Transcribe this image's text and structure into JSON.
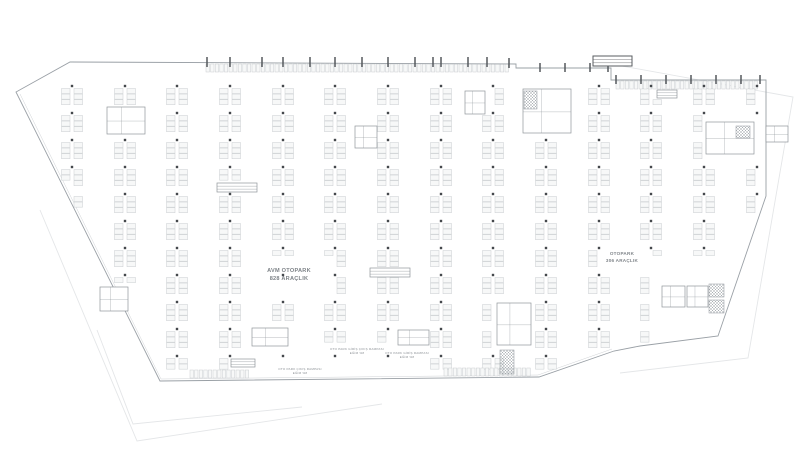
{
  "plan": {
    "labels": {
      "avm_line1": "AVM OTOPARK",
      "avm_line2": "828 ARAÇLIK",
      "right_line1": "OTOPARK",
      "right_line2": "306 ARAÇLIK",
      "ramp_a_line1": "OTO PARK GİRİŞ ÇIKIŞ RAMPASI",
      "ramp_a_line2": "EĞİM %8",
      "ramp_b_line1": "OTO PARK GİRİŞ RAMPASI",
      "ramp_b_line2": "EĞİM %8",
      "ramp_c_line1": "OTO PARK ÇIKIŞ RAMPASI",
      "ramp_c_line2": "EĞİM %8"
    },
    "colors": {
      "background": "#ffffff",
      "outline": "#9aa0a6",
      "faint": "#e4e6e8",
      "stall_stroke": "#c9cdd0",
      "stall_fill": "#f7f8f8",
      "column": "#44484c",
      "core_stroke": "#8f959a",
      "hatch": "#a8aeb2",
      "tick": "#55595d",
      "text": "#7d8287"
    },
    "geometry": {
      "outline_main": [
        [
          70,
          62
        ],
        [
          516,
          64
        ],
        [
          516,
          68
        ],
        [
          611,
          68
        ],
        [
          611,
          80
        ],
        [
          766,
          80
        ],
        [
          766,
          196
        ],
        [
          718,
          336
        ],
        [
          640,
          346
        ],
        [
          614,
          351
        ],
        [
          539,
          377
        ],
        [
          160,
          381
        ],
        [
          16,
          92
        ]
      ],
      "inner_wall": [
        [
          20,
          94
        ],
        [
          161,
          379
        ],
        [
          538,
          375
        ],
        [
          612,
          349
        ]
      ],
      "underlay": [
        [
          [
            40,
            210
          ],
          [
            137,
            441
          ],
          [
            382,
            404
          ]
        ],
        [
          [
            97,
            330
          ],
          [
            133,
            424
          ],
          [
            302,
            407
          ]
        ],
        [
          [
            611,
            64
          ],
          [
            793,
            97
          ],
          [
            748,
            358
          ],
          [
            620,
            373
          ]
        ]
      ],
      "cols": [
        72,
        125,
        177,
        230,
        283,
        335,
        388,
        441,
        493,
        546,
        599,
        651,
        704,
        757
      ],
      "rows": [
        86,
        113,
        140,
        167,
        194,
        221,
        248,
        275,
        302,
        329,
        356,
        376
      ],
      "stall": {
        "offsets": [
          -10.5,
          2
        ],
        "w": 8.5,
        "h": 5.1,
        "step": 5.55,
        "pad": 2.5
      },
      "no_stall": [
        [
          100,
          104,
          48,
          32
        ],
        [
          348,
          122,
          32,
          28
        ],
        [
          458,
          87,
          32,
          30
        ],
        [
          516,
          84,
          60,
          52
        ],
        [
          488,
          298,
          48,
          52
        ],
        [
          645,
          256,
          92,
          88
        ],
        [
          698,
          116,
          60,
          44
        ],
        [
          96,
          282,
          38,
          30
        ],
        [
          244,
          323,
          50,
          24
        ],
        [
          390,
          325,
          44,
          22
        ],
        [
          250,
          256,
          80,
          36
        ],
        [
          596,
          242,
          54,
          24
        ],
        [
          160,
          186,
          360,
          12
        ],
        [
          215,
          181,
          44,
          13
        ],
        [
          368,
          266,
          44,
          13
        ],
        [
          655,
          88,
          24,
          12
        ],
        [
          270,
          342,
          160,
          36
        ],
        [
          228,
          357,
          30,
          12
        ]
      ],
      "no_col": [
        [
          100,
          104,
          48,
          32
        ],
        [
          348,
          122,
          32,
          28
        ],
        [
          458,
          87,
          32,
          30
        ],
        [
          516,
          84,
          60,
          52
        ],
        [
          488,
          298,
          48,
          52
        ],
        [
          645,
          256,
          92,
          88
        ],
        [
          698,
          116,
          60,
          44
        ],
        [
          96,
          282,
          38,
          30
        ],
        [
          244,
          323,
          50,
          24
        ],
        [
          390,
          325,
          44,
          22
        ]
      ],
      "cores": [
        [
          107,
          107,
          38,
          27
        ],
        [
          355,
          126,
          22,
          22
        ],
        [
          465,
          91,
          20,
          23
        ],
        [
          523,
          89,
          48,
          44
        ],
        [
          497,
          303,
          34,
          42
        ],
        [
          662,
          286,
          23,
          21
        ],
        [
          687,
          286,
          21,
          21
        ],
        [
          706,
          122,
          48,
          32
        ],
        [
          100,
          287,
          28,
          24
        ],
        [
          252,
          328,
          36,
          18
        ],
        [
          398,
          330,
          31,
          15
        ],
        [
          766,
          126,
          22,
          16
        ]
      ],
      "hatches": [
        [
          524,
          91,
          13,
          18
        ],
        [
          500,
          350,
          14,
          24
        ],
        [
          709,
          284,
          15,
          13
        ],
        [
          709,
          300,
          15,
          13
        ],
        [
          736,
          126,
          14,
          12
        ]
      ],
      "ramps": [
        {
          "x": 217,
          "y": 183,
          "w": 40,
          "h": 9,
          "dark": false
        },
        {
          "x": 370,
          "y": 268,
          "w": 40,
          "h": 9,
          "dark": false
        },
        {
          "x": 593,
          "y": 56,
          "w": 39,
          "h": 10,
          "dark": true
        },
        {
          "x": 657,
          "y": 90,
          "w": 20,
          "h": 8,
          "dark": false
        },
        {
          "x": 231,
          "y": 359,
          "w": 24,
          "h": 8,
          "dark": false
        }
      ],
      "ticks": [
        {
          "x": 207,
          "y": 57,
          "h": 10
        },
        {
          "x": 230,
          "y": 57,
          "h": 10
        },
        {
          "x": 262,
          "y": 57,
          "h": 10
        },
        {
          "x": 283,
          "y": 57,
          "h": 10
        },
        {
          "x": 310,
          "y": 57,
          "h": 10
        },
        {
          "x": 335,
          "y": 57,
          "h": 10
        },
        {
          "x": 362,
          "y": 57,
          "h": 10
        },
        {
          "x": 388,
          "y": 57,
          "h": 10
        },
        {
          "x": 415,
          "y": 57,
          "h": 10
        },
        {
          "x": 433,
          "y": 57,
          "h": 10
        },
        {
          "x": 441,
          "y": 57,
          "h": 10
        },
        {
          "x": 468,
          "y": 57,
          "h": 10
        },
        {
          "x": 487,
          "y": 57,
          "h": 10
        },
        {
          "x": 509,
          "y": 58,
          "h": 10
        },
        {
          "x": 540,
          "y": 63,
          "h": 9
        },
        {
          "x": 565,
          "y": 63,
          "h": 9
        },
        {
          "x": 590,
          "y": 63,
          "h": 9
        },
        {
          "x": 608,
          "y": 63,
          "h": 9
        },
        {
          "x": 616,
          "y": 75,
          "h": 9
        },
        {
          "x": 641,
          "y": 75,
          "h": 9
        },
        {
          "x": 666,
          "y": 75,
          "h": 9
        },
        {
          "x": 691,
          "y": 75,
          "h": 9
        },
        {
          "x": 716,
          "y": 75,
          "h": 9
        },
        {
          "x": 741,
          "y": 75,
          "h": 9
        },
        {
          "x": 760,
          "y": 75,
          "h": 9
        }
      ],
      "edge_rows": [
        {
          "x1": 206,
          "x2": 512,
          "y": 64,
          "h": 8
        },
        {
          "x1": 616,
          "x2": 760,
          "y": 81,
          "h": 8
        },
        {
          "x1": 190,
          "x2": 252,
          "y": 370,
          "h": 8
        },
        {
          "x1": 444,
          "x2": 534,
          "y": 368,
          "h": 8
        }
      ]
    }
  }
}
